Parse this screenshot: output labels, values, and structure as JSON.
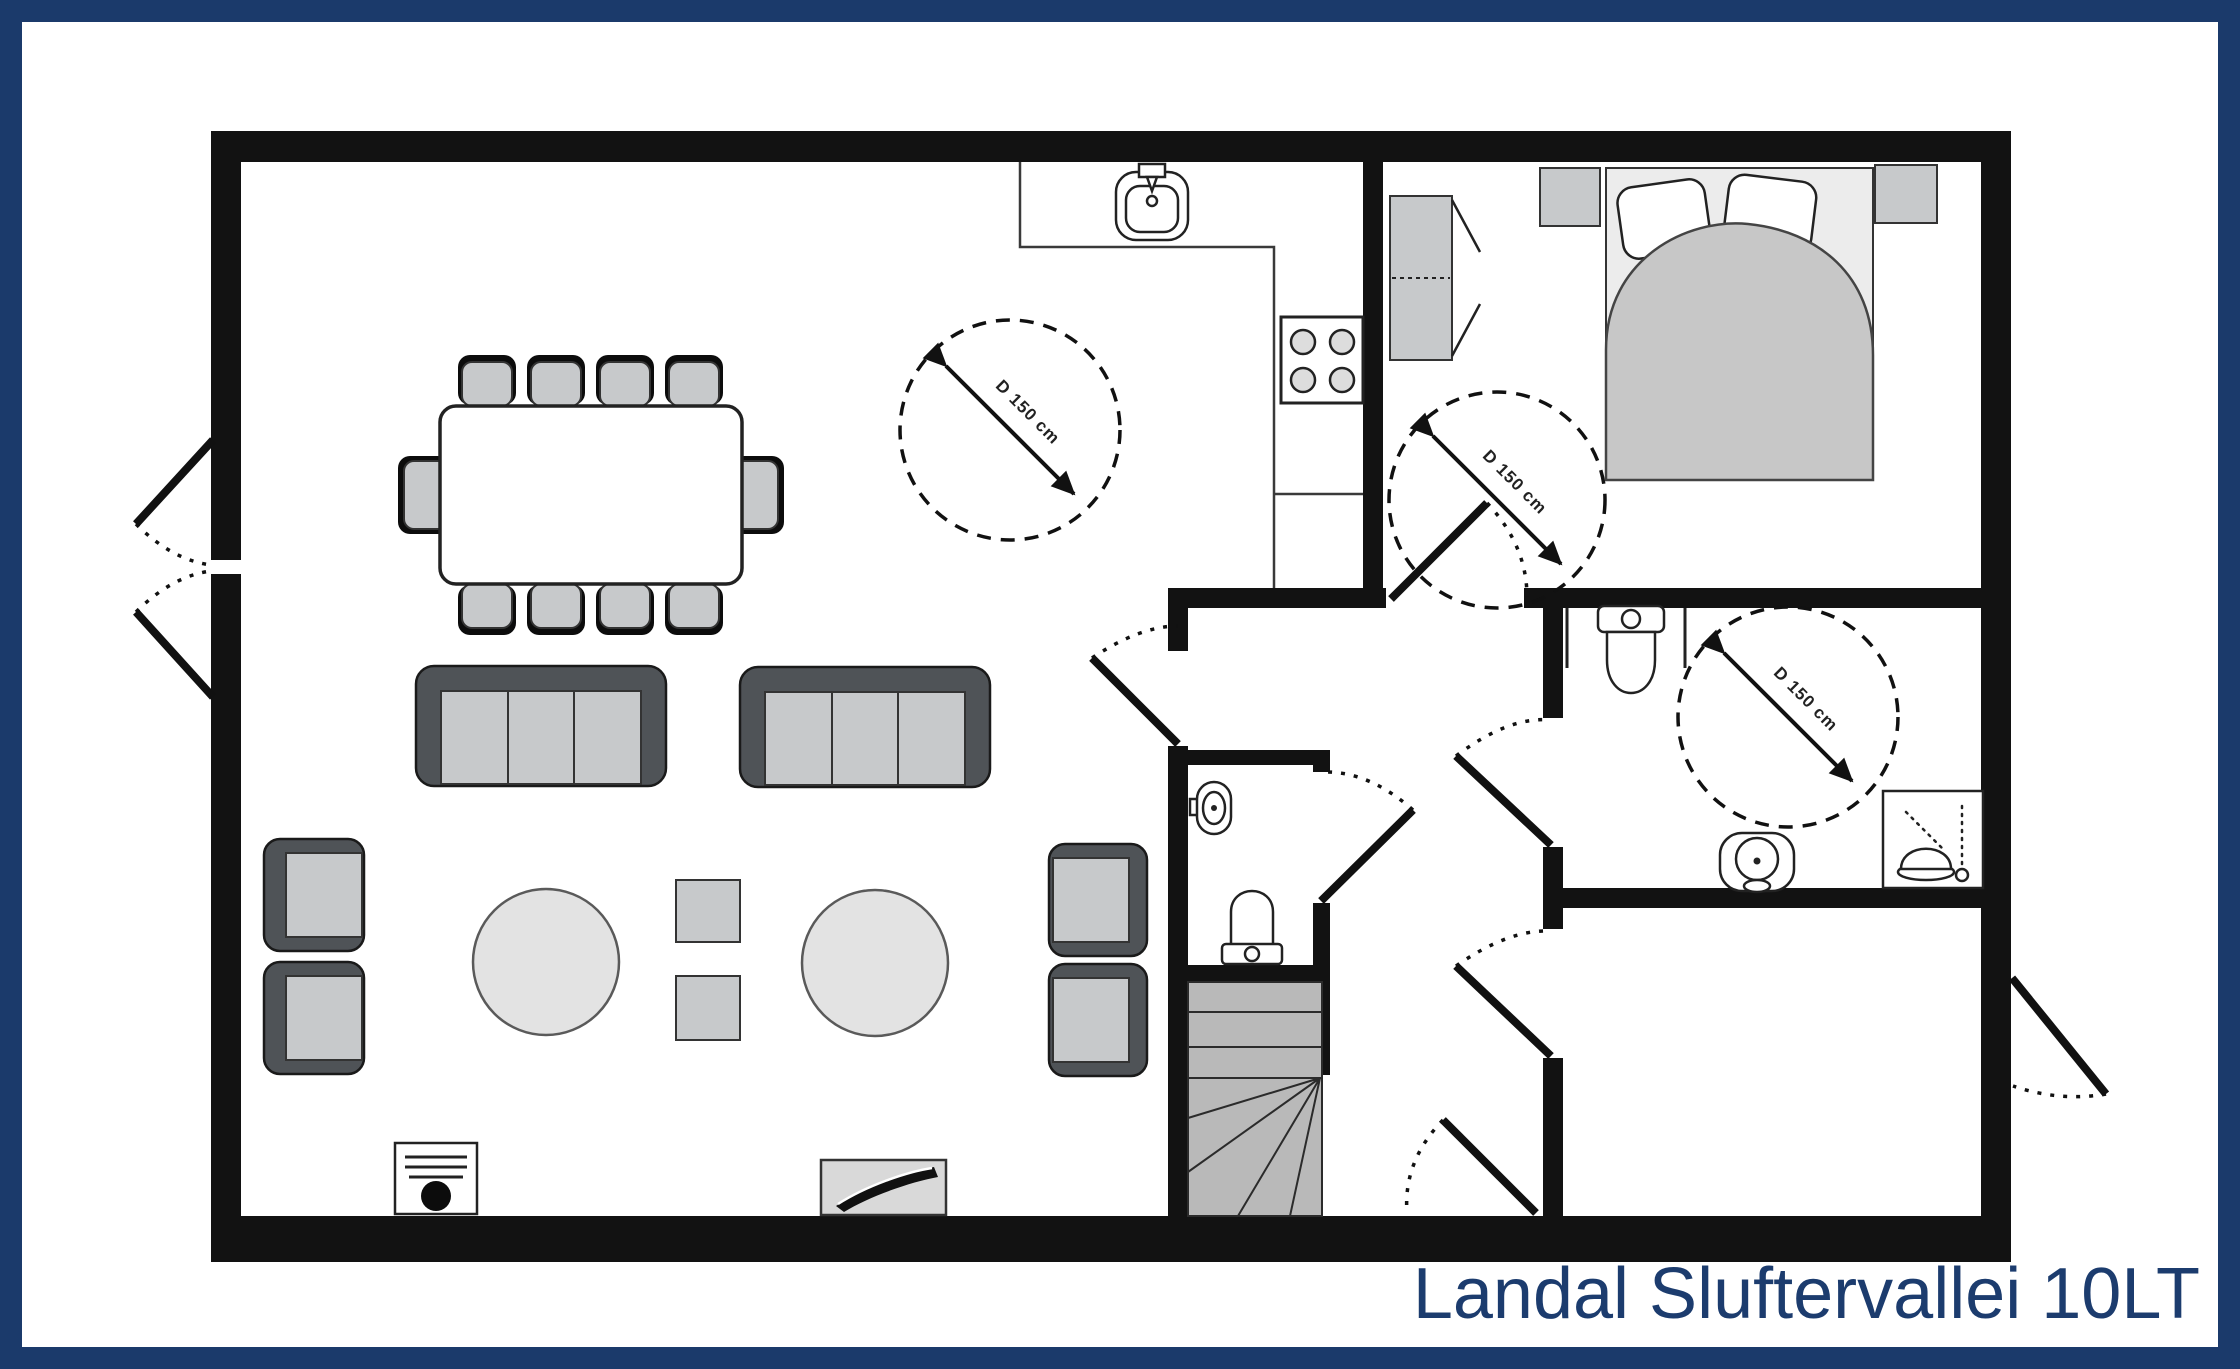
{
  "title": "Landal Sluftervallei 10LT",
  "turning_circles": [
    {
      "location": "living-room",
      "label": "D 150 cm"
    },
    {
      "location": "bedroom",
      "label": "D 150 cm"
    },
    {
      "location": "bathroom",
      "label": "D 150 cm"
    }
  ],
  "colors": {
    "frame_navy": "#1b3a6b",
    "title_navy": "#1c3c6e",
    "wall_black": "#121212",
    "furniture_dark": "#4f5357",
    "furniture_gray": "#c7c9cb",
    "furniture_light": "#e3e3e3"
  }
}
